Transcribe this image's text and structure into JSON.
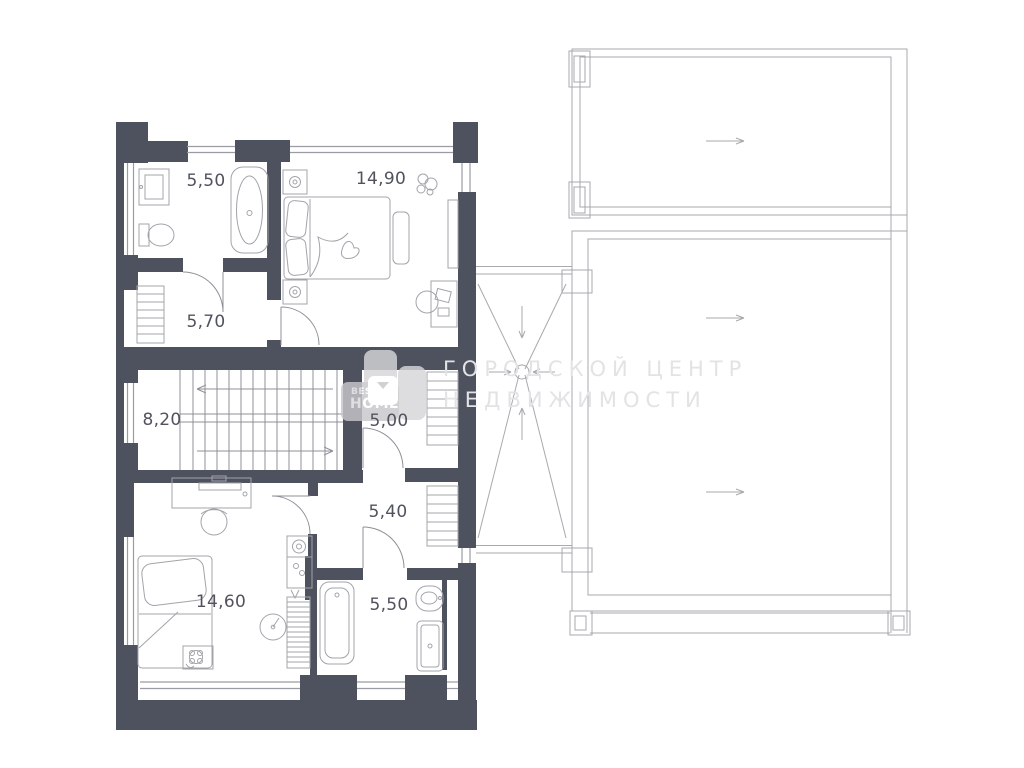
{
  "watermark": {
    "line1": "ГОРОДСКОЙ ЦЕНТР",
    "line2": "НЕДВИЖИМОСТИ"
  },
  "logo": {
    "top": "BEST",
    "bottom": "HOMES"
  },
  "rooms": [
    {
      "name": "bathroom-upper",
      "area": "5,50"
    },
    {
      "name": "bedroom-upper",
      "area": "14,90"
    },
    {
      "name": "hallway",
      "area": "5,70"
    },
    {
      "name": "stair-hall",
      "area": "8,20"
    },
    {
      "name": "corridor-upper",
      "area": "5,00"
    },
    {
      "name": "corridor-lower",
      "area": "5,40"
    },
    {
      "name": "bedroom-lower",
      "area": "14,60"
    },
    {
      "name": "bathroom-lower",
      "area": "5,50"
    }
  ],
  "colors": {
    "wall": "#4e525e",
    "furniture_line": "#a3a4aa",
    "window_line": "#9b9ca3",
    "roof_line": "#a9a9ae",
    "label_text": "#50535d",
    "watermark_text": "#e3e3e6"
  }
}
